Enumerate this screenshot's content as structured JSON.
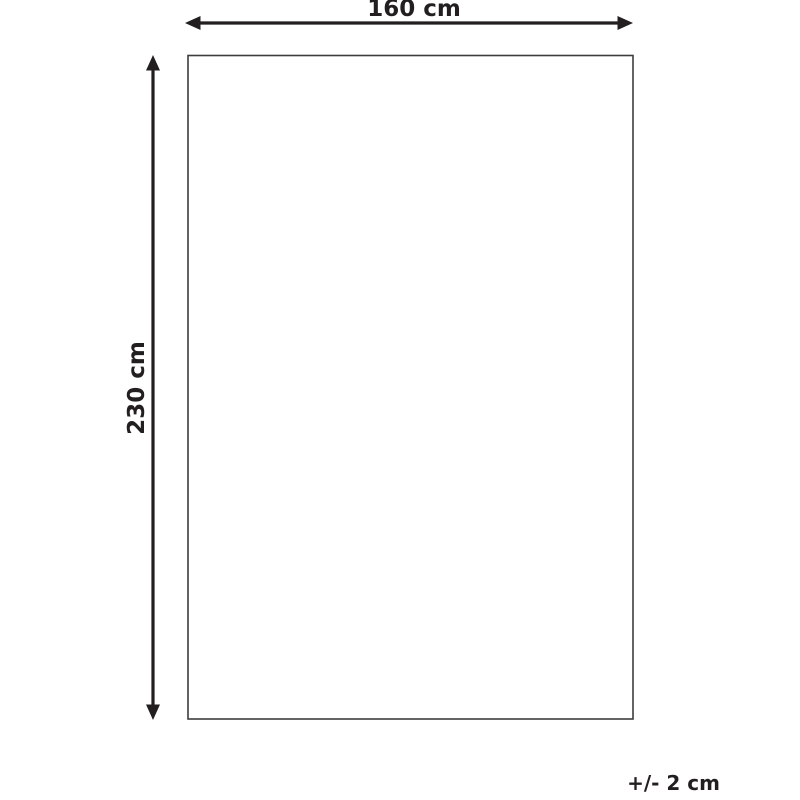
{
  "diagram": {
    "width_label": "160 cm",
    "height_label": "230 cm",
    "tolerance_label": "+/- 2 cm",
    "colors": {
      "ink": "#231f20",
      "outline": "#3d3d3d",
      "background": "#ffffff"
    }
  }
}
